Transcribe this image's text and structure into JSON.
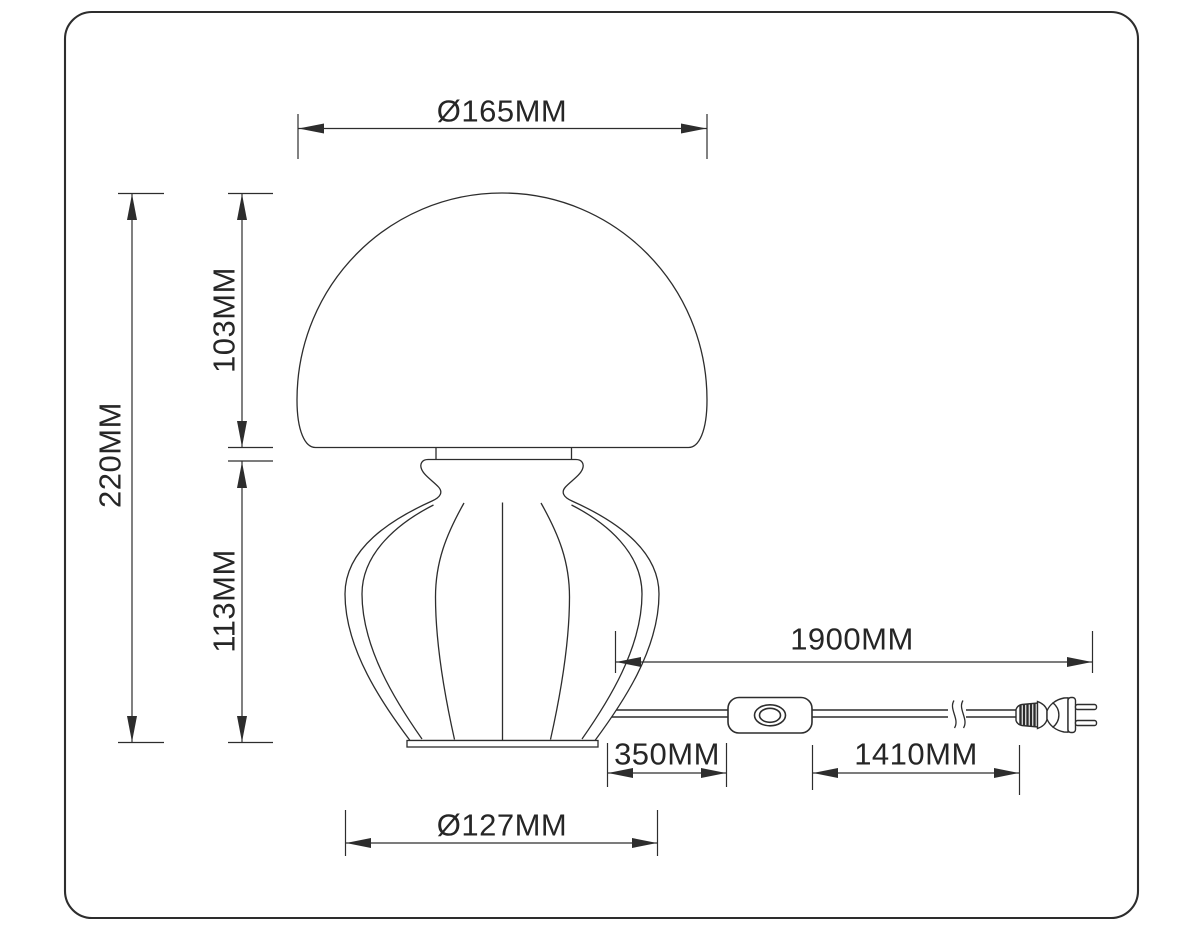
{
  "diagram": {
    "type": "technical-dimension-drawing",
    "subject": "mushroom table lamp with inline cord switch and two-prong plug",
    "colors": {
      "line": "#2d2d2d",
      "text": "#262626",
      "background": "#ffffff"
    },
    "dimensions": {
      "shade_diameter": "Ø165MM",
      "shade_height": "103MM",
      "total_height": "220MM",
      "base_height": "113MM",
      "cord_total_length": "1900MM",
      "cord_lamp_to_switch": "350MM",
      "cord_switch_to_plug": "1410MM",
      "base_diameter": "Ø127MM"
    }
  }
}
